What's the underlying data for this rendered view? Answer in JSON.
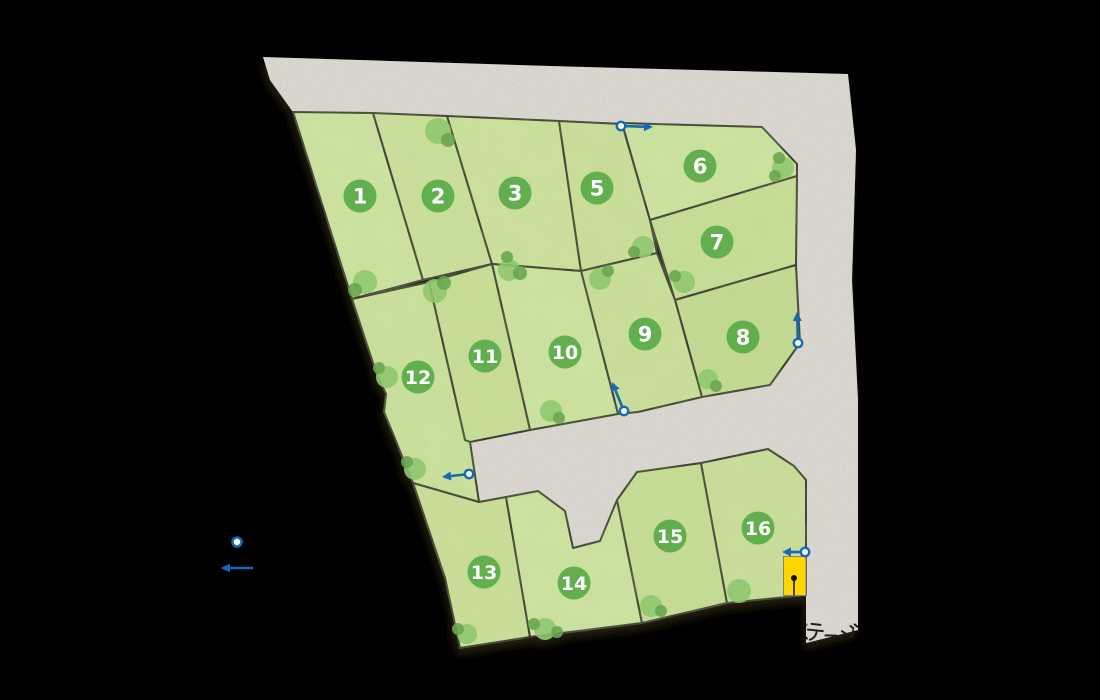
{
  "map": {
    "background": "#000000",
    "stroke_color": "#33312a",
    "arrow_color": "#1769b3",
    "road": {
      "color": "#dcd9d2",
      "outline": "263,57 550,66 848,74 856,150 852,280 858,400 858,630 806,643 806,480 794,466 768,449 752,451 699,463 637,472 617,500 600,541 573,548 565,511 538,491 506,497 479,502 470,442 530,430 618,414 638,412 702,397 770,385 800,343 796,265 797,163 762,127 622,123 559,121 447,116 373,113 293,112 270,80"
    },
    "badge": {
      "fill": "#5dac4b",
      "text_color": "#ffffff",
      "radius": 16.5
    },
    "lots": [
      {
        "id": "1",
        "label": "1",
        "fill": "#cde3a1",
        "badge": {
          "x": 360,
          "y": 196
        },
        "points": "293,112 373,113 423,280 352,299"
      },
      {
        "id": "2",
        "label": "2",
        "fill": "#cae09b",
        "badge": {
          "x": 438,
          "y": 196
        },
        "points": "373,113 447,116 492,264 423,280"
      },
      {
        "id": "3",
        "label": "3",
        "fill": "#cce19e",
        "badge": {
          "x": 515,
          "y": 193
        },
        "points": "447,116 559,121 581,271 492,264"
      },
      {
        "id": "5",
        "label": "5",
        "fill": "#c9df9a",
        "badge": {
          "x": 597,
          "y": 188
        },
        "points": "559,121 622,124 650,220 657,253 581,271"
      },
      {
        "id": "6",
        "label": "6",
        "fill": "#cde3a0",
        "badge": {
          "x": 700,
          "y": 166
        },
        "points": "622,123 762,127 797,164 797,176 650,220"
      },
      {
        "id": "7",
        "label": "7",
        "fill": "#c7de97",
        "badge": {
          "x": 717,
          "y": 242
        },
        "points": "650,220 797,176 796,265 675,300"
      },
      {
        "id": "8",
        "label": "8",
        "fill": "#c3da92",
        "badge": {
          "x": 743,
          "y": 337
        },
        "points": "675,300 796,265 800,343 770,385 702,397"
      },
      {
        "id": "9",
        "label": "9",
        "fill": "#c9df9a",
        "badge": {
          "x": 645,
          "y": 334
        },
        "points": "581,271 657,253 675,300 702,397 638,412 618,414"
      },
      {
        "id": "10",
        "label": "10",
        "fill": "#cde3a1",
        "badge": {
          "x": 565,
          "y": 352
        },
        "points": "492,264 581,271 618,414 530,430"
      },
      {
        "id": "11",
        "label": "11",
        "fill": "#c8de98",
        "badge": {
          "x": 485,
          "y": 356
        },
        "points": "429,282 492,264 530,430 470,442 465,440"
      },
      {
        "id": "12",
        "label": "12",
        "fill": "#cbe19d",
        "badge": {
          "x": 418,
          "y": 377
        },
        "points": "352,299 429,282 465,440 470,442 479,502 413,483 384,412 386,394 376,372"
      },
      {
        "id": "13",
        "label": "13",
        "fill": "#c9df99",
        "badge": {
          "x": 484,
          "y": 572
        },
        "points": "413,483 479,502 506,497 530,637 460,648 445,578"
      },
      {
        "id": "14",
        "label": "14",
        "fill": "#cde3a2",
        "badge": {
          "x": 574,
          "y": 583
        },
        "points": "506,497 538,491 565,511 573,548 600,541 617,500 642,623 530,637"
      },
      {
        "id": "15",
        "label": "15",
        "fill": "#c6dd96",
        "badge": {
          "x": 670,
          "y": 536
        },
        "points": "617,500 637,472 701,463 727,603 642,623"
      },
      {
        "id": "16",
        "label": "16",
        "fill": "#cade9b",
        "badge": {
          "x": 758,
          "y": 528
        },
        "points": "701,463 768,449 794,466 806,480 806,595 727,603"
      }
    ],
    "trees": {
      "big_color": "#8ec66d",
      "small_color": "#69a450",
      "blobs": [
        [
          438,
          131,
          13,
          "b"
        ],
        [
          448,
          140,
          7,
          "s"
        ],
        [
          365,
          282,
          12,
          "b"
        ],
        [
          355,
          290,
          7,
          "s"
        ],
        [
          435,
          291,
          12,
          "b"
        ],
        [
          444,
          283,
          7,
          "s"
        ],
        [
          509,
          270,
          11,
          "b"
        ],
        [
          520,
          273,
          7,
          "s"
        ],
        [
          507,
          257,
          6,
          "s"
        ],
        [
          600,
          279,
          11,
          "b"
        ],
        [
          608,
          271,
          6,
          "s"
        ],
        [
          643,
          247,
          11,
          "b"
        ],
        [
          634,
          252,
          6,
          "s"
        ],
        [
          684,
          282,
          11,
          "b"
        ],
        [
          675,
          276,
          6,
          "s"
        ],
        [
          783,
          168,
          11,
          "b"
        ],
        [
          779,
          158,
          6,
          "s"
        ],
        [
          775,
          176,
          6,
          "s"
        ],
        [
          387,
          377,
          11,
          "b"
        ],
        [
          379,
          368,
          6,
          "s"
        ],
        [
          415,
          469,
          11,
          "b"
        ],
        [
          407,
          462,
          6,
          "s"
        ],
        [
          551,
          411,
          11,
          "b"
        ],
        [
          559,
          418,
          6,
          "s"
        ],
        [
          708,
          379,
          10,
          "b"
        ],
        [
          716,
          386,
          6,
          "s"
        ],
        [
          739,
          591,
          12,
          "b"
        ],
        [
          651,
          606,
          11,
          "b"
        ],
        [
          661,
          611,
          6,
          "s"
        ],
        [
          545,
          629,
          11,
          "b"
        ],
        [
          557,
          632,
          6,
          "s"
        ],
        [
          534,
          624,
          6,
          "s"
        ],
        [
          467,
          634,
          10,
          "b"
        ],
        [
          458,
          629,
          6,
          "s"
        ]
      ]
    },
    "arrows": [
      {
        "name": "entrance-arrow-lot5",
        "cx": 621,
        "cy": 126,
        "tx": 653,
        "ty": 127
      },
      {
        "name": "entrance-arrow-lot8",
        "cx": 798,
        "cy": 343,
        "tx": 797,
        "ty": 312
      },
      {
        "name": "entrance-arrow-lot9",
        "cx": 624,
        "cy": 411,
        "tx": 612,
        "ty": 382
      },
      {
        "name": "entrance-arrow-lot12",
        "cx": 469,
        "cy": 474,
        "tx": 442,
        "ty": 477
      },
      {
        "name": "entrance-arrow-lot16",
        "cx": 805,
        "cy": 552,
        "tx": 782,
        "ty": 552
      }
    ],
    "legend": {
      "cx": 237,
      "cy": 542,
      "ax1": 253,
      "ay": 568,
      "ax2": 221
    },
    "marker": {
      "x": 783.5,
      "y": 556.5,
      "w": 22.5,
      "h": 39,
      "fill": "#ffd402",
      "dot_x": 794,
      "dot_y": 578,
      "stem_y2": 595.5
    },
    "label": {
      "text": "ステージ",
      "x": 793,
      "y": 634,
      "rotate": 6,
      "color": "#1e1e1e"
    }
  }
}
